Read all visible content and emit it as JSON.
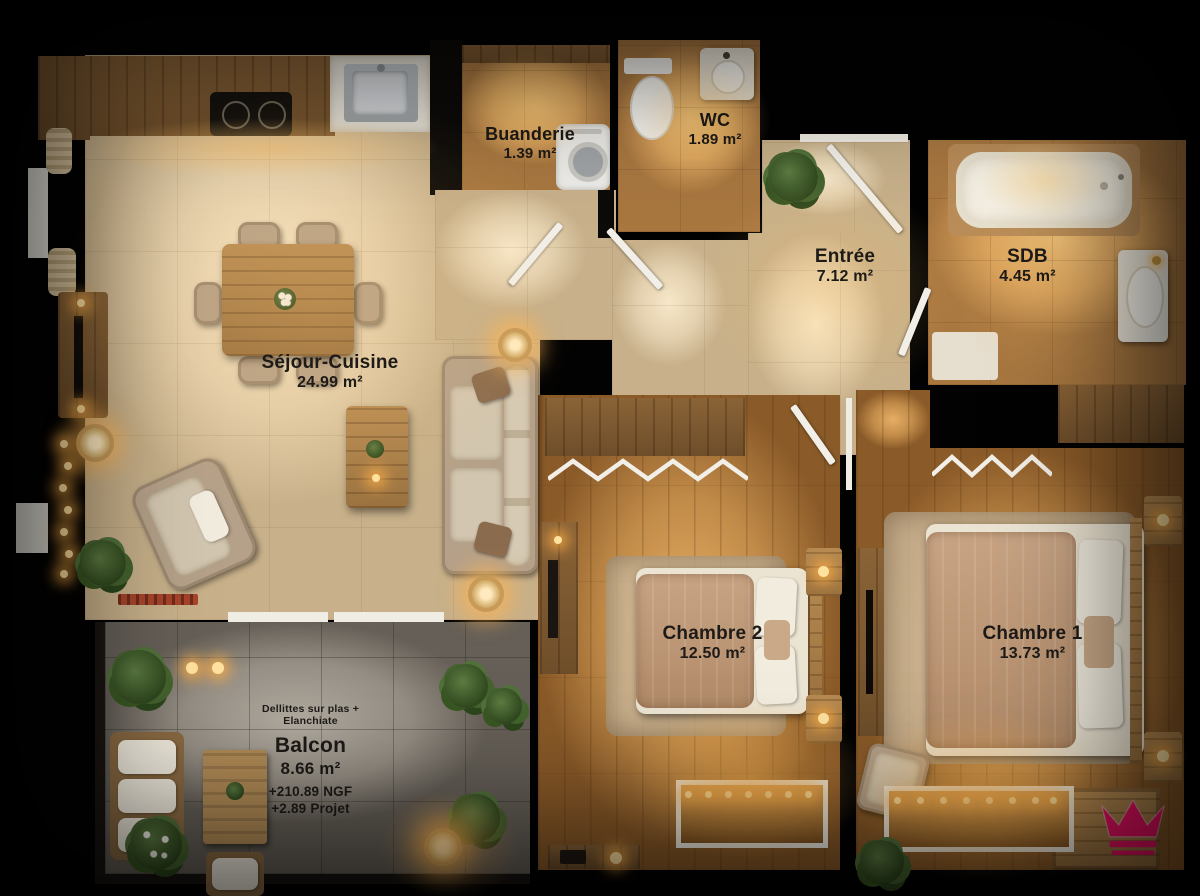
{
  "plan": {
    "rooms": [
      {
        "name": "Séjour-Cuisine",
        "area": "24.99 m²"
      },
      {
        "name": "Buanderie",
        "area": "1.39 m²"
      },
      {
        "name": "WC",
        "area": "1.89 m²"
      },
      {
        "name": "Entrée",
        "area": "7.12 m²"
      },
      {
        "name": "SDB",
        "area": "4.45 m²"
      },
      {
        "name": "Chambre 2",
        "area": "12.50 m²"
      },
      {
        "name": "Chambre 1",
        "area": "13.73 m²"
      },
      {
        "name": "Balcon",
        "area": "8.66 m²"
      }
    ],
    "balcony_notes": {
      "line1": "Dellittes sur plas +",
      "line2": "Elanchiate",
      "level1": "+210.89 NGF",
      "level2": "+2.89 Projet"
    },
    "logo": {
      "name": "crown",
      "color": "#ED1164"
    },
    "palette": {
      "floor_tile": "#e3d0ae",
      "floor_bath": "#d9a25c",
      "floor_wood": "#c08a48",
      "floor_balcony": "#958e84",
      "wall": "#0d0b09"
    }
  }
}
